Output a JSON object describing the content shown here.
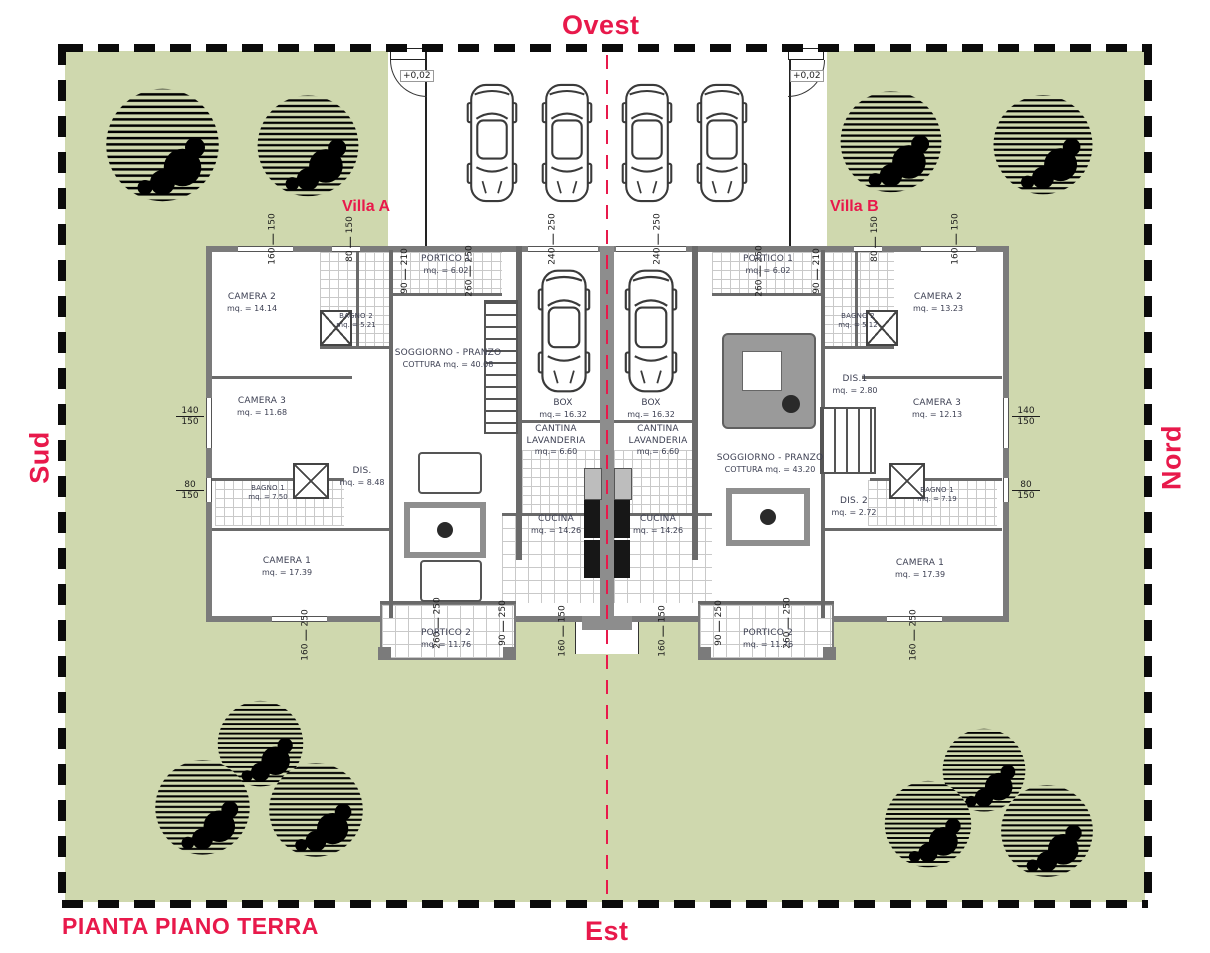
{
  "colors": {
    "accent_red": "#e8194b",
    "lawn_green": "#cfd8ae",
    "wall_gray": "#7b7b7b"
  },
  "compass": {
    "top": "Ovest",
    "bottom": "Est",
    "left": "Sud",
    "right": "Nord"
  },
  "plan_title": "PIANTA PIANO TERRA",
  "levels": {
    "left_gate": "+0,02",
    "right_gate": "+0,02"
  },
  "villa_a": {
    "name": "Villa A",
    "rooms": {
      "camera2": {
        "name": "CAMERA 2",
        "area": "mq. = 14.14"
      },
      "bagno2": {
        "name": "BAGNO 2",
        "area": "mq. = 5.21"
      },
      "portico1": {
        "name": "PORTICO 1",
        "area": "mq. = 6.02"
      },
      "soggiorno": {
        "name": "SOGGIORNO - PRANZO",
        "area": "COTTURA mq. = 40.08"
      },
      "camera3": {
        "name": "CAMERA 3",
        "area": "mq. = 11.68"
      },
      "bagno1": {
        "name": "BAGNO 1",
        "area": "mq. = 7.50"
      },
      "dis": {
        "name": "DIS.",
        "area": "mq. = 8.48"
      },
      "camera1": {
        "name": "CAMERA 1",
        "area": "mq. = 17.39"
      },
      "cucina": {
        "name": "CUCINA",
        "area": "mq. = 14.26"
      },
      "portico2": {
        "name": "PORTICO 2",
        "area": "mq. = 11.76"
      },
      "box": {
        "name": "BOX",
        "area": "mq.= 16.32"
      },
      "cantina": {
        "line1": "CANTINA",
        "line2": "LAVANDERIA",
        "area": "mq.= 6.60"
      }
    }
  },
  "villa_b": {
    "name": "Villa B",
    "rooms": {
      "camera2": {
        "name": "CAMERA 2",
        "area": "mq. = 13.23"
      },
      "bagno2": {
        "name": "BAGNO 2",
        "area": "mq. = 5.12"
      },
      "portico1": {
        "name": "PORTICO 1",
        "area": "mq. = 6.02"
      },
      "soggiorno": {
        "name": "SOGGIORNO - PRANZO",
        "area": "COTTURA mq. = 43.20"
      },
      "dis1": {
        "name": "DIS.1",
        "area": "mq. = 2.80"
      },
      "camera3": {
        "name": "CAMERA 3",
        "area": "mq. = 12.13"
      },
      "bagno1": {
        "name": "BAGNO 1",
        "area": "mq. = 7.19"
      },
      "dis2": {
        "name": "DIS. 2",
        "area": "mq. = 2.72"
      },
      "camera1": {
        "name": "CAMERA 1",
        "area": "mq. = 17.39"
      },
      "cucina": {
        "name": "CUCINA",
        "area": "mq. = 14.26"
      },
      "portico2": {
        "name": "PORTICO 2",
        "area": "mq. = 11.76"
      },
      "box": {
        "name": "BOX",
        "area": "mq.= 16.32"
      },
      "cantina": {
        "line1": "CANTINA",
        "line2": "LAVANDERIA",
        "area": "mq.= 6.60"
      }
    }
  },
  "dims": {
    "top": [
      [
        "160",
        "150"
      ],
      [
        "80",
        "150"
      ],
      [
        "240",
        "250"
      ],
      [
        "240",
        "250"
      ],
      [
        "80",
        "150"
      ],
      [
        "160",
        "150"
      ]
    ],
    "portico_inner": [
      [
        "90",
        "210"
      ],
      [
        "260",
        "250"
      ],
      [
        "260",
        "250"
      ],
      [
        "90",
        "210"
      ]
    ],
    "left": [
      [
        "140",
        "150"
      ],
      [
        "80",
        "150"
      ]
    ],
    "right": [
      [
        "140",
        "150"
      ],
      [
        "80",
        "150"
      ]
    ],
    "bottom": [
      [
        "160",
        "250"
      ],
      [
        "260",
        "250"
      ],
      [
        "90",
        "250"
      ],
      [
        "160",
        "150"
      ],
      [
        "160",
        "150"
      ],
      [
        "90",
        "250"
      ],
      [
        "260",
        "250"
      ],
      [
        "160",
        "250"
      ]
    ]
  }
}
